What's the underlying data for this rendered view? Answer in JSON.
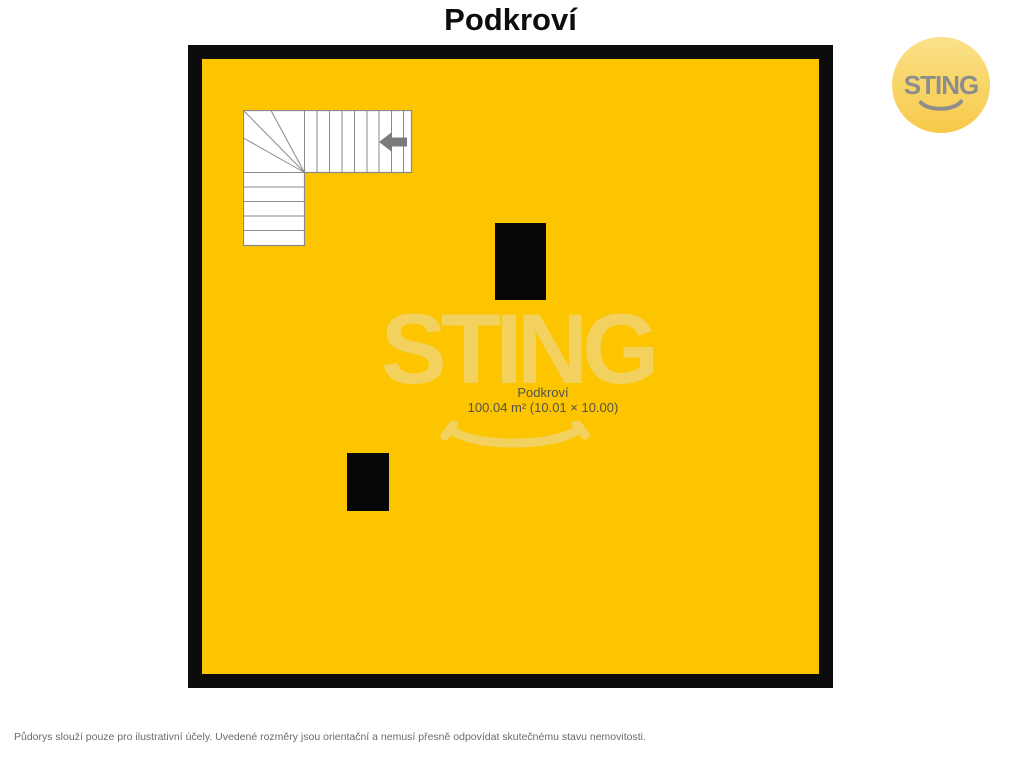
{
  "header": {
    "title": "Podkroví"
  },
  "plan": {
    "room": {
      "name": "Podkroví",
      "dimensions": "100.04 m² (10.01 × 10.00)"
    },
    "features": {
      "staircase": "L-shaped staircase with winder steps and direction arrow",
      "chimneys": 2
    },
    "colors": {
      "floor_fill": "#FCC500",
      "wall": "#0C0C0C",
      "stair_fill": "#FFFFFF",
      "stair_line": "#8A8A8A",
      "arrow": "#7B7B7B",
      "chimney": "#060606",
      "label_text": "#55534B"
    }
  },
  "watermark": {
    "text": "STING",
    "color": "#F2D15E"
  },
  "logo": {
    "text": "STING",
    "text_color": "#8D8D8D",
    "circle_top_color": "#FAE189",
    "circle_bottom_color": "#F7C94B"
  },
  "footer": {
    "disclaimer": "Půdorys slouží pouze pro ilustrativní účely. Uvedené rozměry jsou orientační a nemusí přesně odpovídat skutečnému stavu nemovitosti."
  }
}
